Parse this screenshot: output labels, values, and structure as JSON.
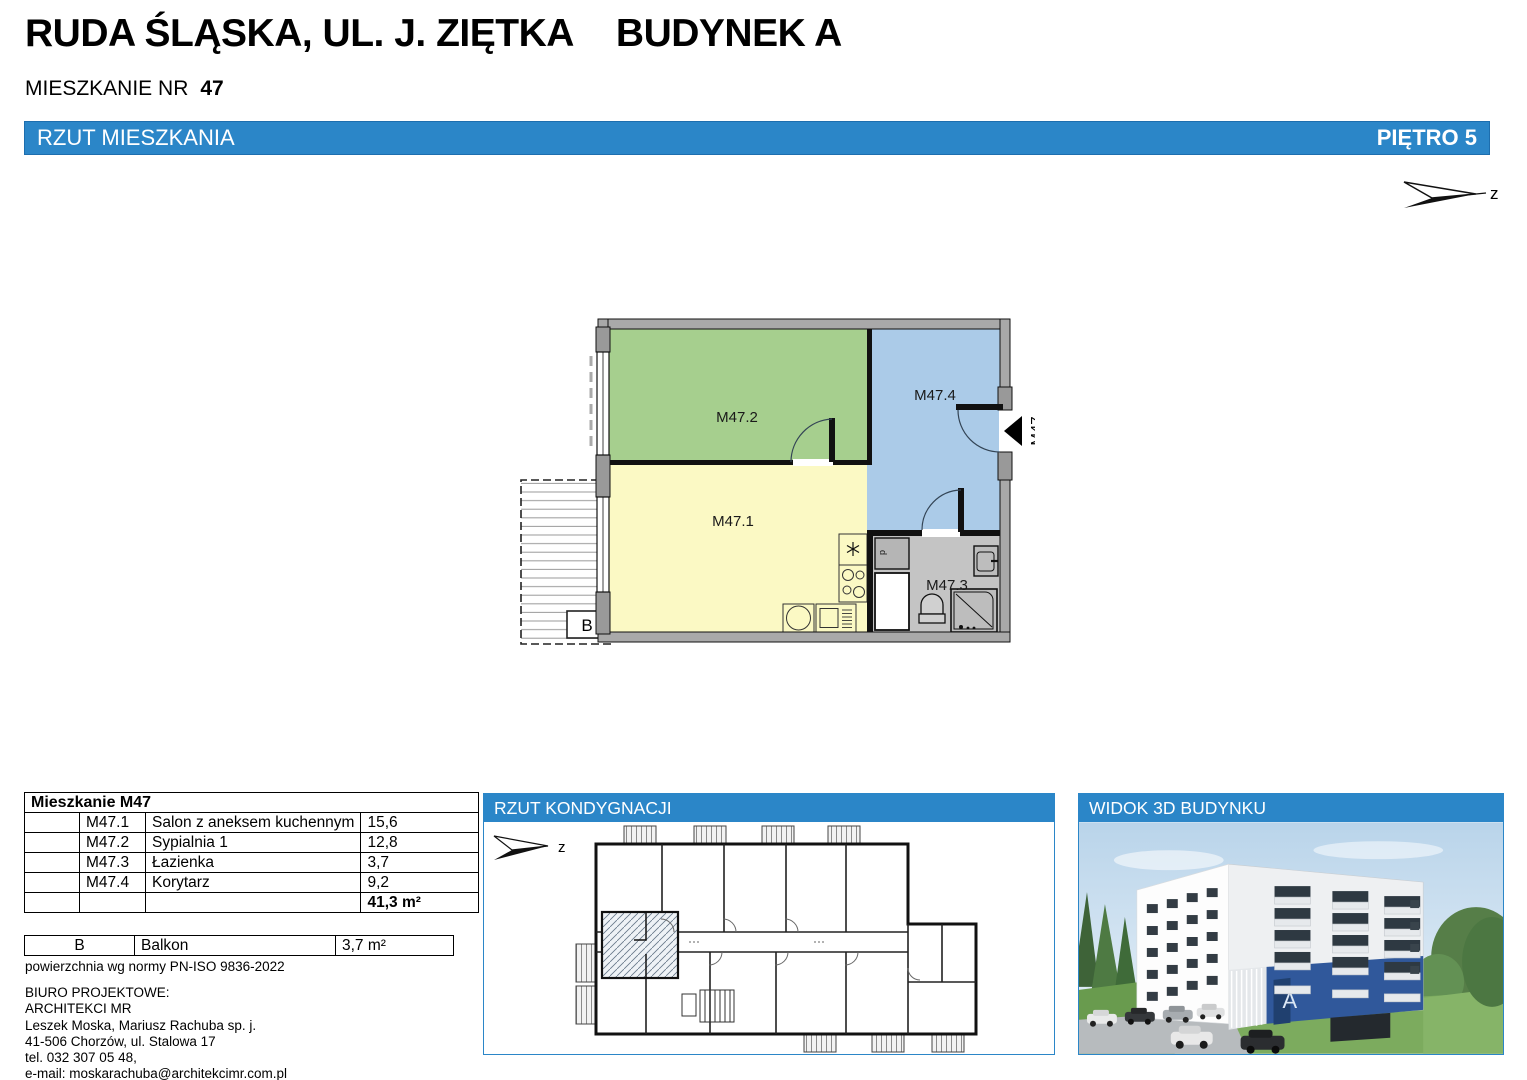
{
  "header": {
    "title_left": "RUDA ŚLĄSKA, UL. J. ZIĘTKA",
    "title_right": "BUDYNEK A",
    "apartment_label": "MIESZKANIE NR",
    "apartment_number": "47"
  },
  "titlebar": {
    "left": "RZUT MIESZKANIA",
    "right": "PIĘTRO 5"
  },
  "compass_label": "z",
  "plan": {
    "room1": "M47.1",
    "room2": "M47.2",
    "room3": "M47.3",
    "room4": "M47.4",
    "entry": "M47",
    "balcony": "B",
    "washer": "p"
  },
  "area_table": {
    "title": "Mieszkanie M47",
    "rows": [
      {
        "code": "M47.1",
        "name": "Salon z aneksem kuchennym",
        "value": "15,6"
      },
      {
        "code": "M47.2",
        "name": "Sypialnia 1",
        "value": "12,8"
      },
      {
        "code": "M47.3",
        "name": "Łazienka",
        "value": "3,7"
      },
      {
        "code": "M47.4",
        "name": "Korytarz",
        "value": "9,2"
      }
    ],
    "total": "41,3 m²"
  },
  "balcony_table": {
    "code": "B",
    "name": "Balkon",
    "value": "3,7 m²"
  },
  "footer": {
    "norm": "powierzchnia wg normy PN-ISO 9836-2022",
    "office_label": "BIURO PROJEKTOWE:",
    "office_name": "ARCHITEKCI MR",
    "partners": "Leszek Moska, Mariusz Rachuba sp. j.",
    "address": "41-506 Chorzów, ul. Stalowa 17",
    "phone": "tel. 032 307 05 48,",
    "email": "e-mail: moskarachuba@architekcimr.com.pl"
  },
  "kondygnacja": {
    "title": "RZUT KONDYGNACJI"
  },
  "view3d": {
    "title": "WIDOK 3D BUDYNKU",
    "building_letter": "A"
  },
  "colors": {
    "accent": "#2b86c8",
    "room_living": "#fbf9c4",
    "room_bedroom": "#a6cf8e",
    "room_corridor": "#abcbe8",
    "room_bath": "#c4c4c4"
  }
}
